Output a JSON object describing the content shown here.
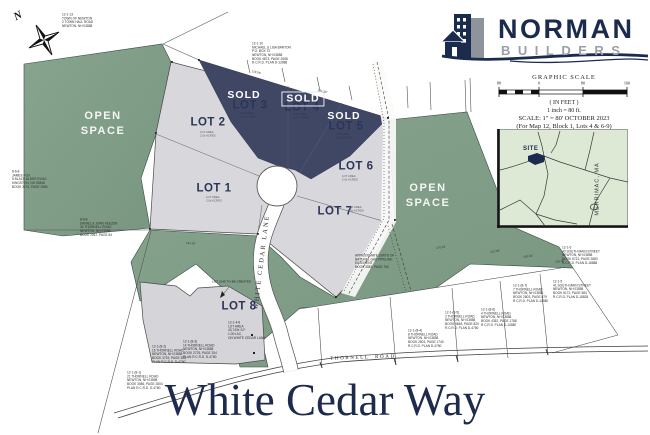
{
  "brand": {
    "primary": "NORMAN",
    "secondary": "BUILDERS",
    "navy": "#1b2b4d",
    "gray": "#9aa0a8"
  },
  "north_label": "N",
  "title": "White Cedar Way",
  "colors": {
    "open_space_green": "#85a08b",
    "lot_gray": "#d8d8dc",
    "sold_navy": "#3f4765",
    "title_navy": "#1e2b4e"
  },
  "scale_block": {
    "heading": "GRAPHIC SCALE",
    "ticks": [
      {
        "t": "80",
        "x": 2
      },
      {
        "t": "0",
        "x": 42
      },
      {
        "t": "80",
        "x": 86
      },
      {
        "t": "160",
        "x": 130
      }
    ],
    "in_feet": "( IN FEET )",
    "inch_note": "1 inch = 80 ft.",
    "scale_line": "SCALE: 1\" = 80'    OCTOBER 2023",
    "subtitle": "(For Map 12, Block 1, Lots 4 & 6-9)"
  },
  "inset_map": {
    "site_label": "SITE",
    "region_label": "MERRIMAC, MA"
  },
  "map": {
    "road_labels": {
      "lane": "WHITE CEDAR LANE",
      "thornell": "THORNELL  ROAD"
    },
    "lot_line_note": "LOT LINE TO BE CREATED",
    "open_space_labels": [
      {
        "x": 103,
        "y": 124,
        "lines": "OPEN\nSPACE"
      },
      {
        "x": 428,
        "y": 196,
        "lines": "OPEN\nSPACE"
      }
    ],
    "lot_labels": [
      {
        "t": "LOT 1",
        "x": 214,
        "y": 189
      },
      {
        "t": "LOT 2",
        "x": 208,
        "y": 123
      },
      {
        "t": "LOT 3",
        "x": 250,
        "y": 106
      },
      {
        "t": "LOT 4",
        "x": 302,
        "y": 108
      },
      {
        "t": "LOT 5",
        "x": 346,
        "y": 127
      },
      {
        "t": "LOT 6",
        "x": 356,
        "y": 167
      },
      {
        "t": "LOT 7",
        "x": 335,
        "y": 212
      },
      {
        "t": "LOT 8",
        "x": 239,
        "y": 307
      }
    ],
    "sold_labels": [
      {
        "t": "SOLD",
        "x": 244,
        "y": 95
      },
      {
        "t": "SOLD",
        "x": 303,
        "y": 99,
        "boxed": true
      },
      {
        "t": "SOLD",
        "x": 344,
        "y": 116
      }
    ],
    "lot_area_notes": [
      {
        "x": 200,
        "y": 131,
        "lines": "LOT AREA\n2.0± ACRES"
      },
      {
        "x": 206,
        "y": 196,
        "lines": "LOT AREA\n2.0± ACRES"
      },
      {
        "x": 240,
        "y": 112,
        "lines": "LOT AREA\n2.0± ACRES",
        "dark": true
      },
      {
        "x": 293,
        "y": 113,
        "lines": "LOT AREA\n2.0± ACRES",
        "dark": true
      },
      {
        "x": 336,
        "y": 133,
        "lines": "LOT AREA\n2.0± ACRES",
        "dark": true
      },
      {
        "x": 342,
        "y": 175,
        "lines": "LOT AREA\n2.0± ACRES"
      },
      {
        "x": 348,
        "y": 206,
        "lines": "LOT AREA\n2.0± ACRES"
      }
    ],
    "parcel_notes": [
      {
        "x": 62,
        "y": 13,
        "lines": "12-1-13\nTOWN OF NEWTON\n2 TOWN HALL ROAD\nNEWTON, NH 03858"
      },
      {
        "x": 252,
        "y": 42,
        "lines": "12-1-10\nMICHAEL & LISA BARTON\nP.O. BOX 73\nNEWTON, NH 03858\nBOOK 4873, PAGE 2658\nR.C.R.D. PLAN D-13988"
      },
      {
        "x": 12,
        "y": 170,
        "lines": "8-6-8\nJAMES FOX\n5 BLACK ALDER ROAD\nKINGSTON, NH 03848\nBOOK 3731, PAGE 2980"
      },
      {
        "x": 80,
        "y": 218,
        "lines": "8-6-8\nDANIEL & JOAN KEEZER\n34 THORNELL ROAD\nNEWTON, NH 03858\nBOOK 2067, PAGE 84"
      },
      {
        "x": 127,
        "y": 371,
        "lines": "12-1-(8-1)\n21 THORNELL ROAD\nNEWTON, NH 03858\nBOOK 3086, PAGE 2804\nPLAN R.C.R.D. D-4780"
      },
      {
        "x": 152,
        "y": 345,
        "lines": "12-1-(8-2)\n16 THORNELL ROAD\nNEWTON, NH 03858\nBOOK 3725, PAGE 358\nPLAN R.C.R.D. D-4780"
      },
      {
        "x": 228,
        "y": 321,
        "lines": "12-1-4-8\nLOT AREA\n43,743± S.F.\n1.00± AC.\nON WHITE CEDAR LANE"
      },
      {
        "x": 183,
        "y": 340,
        "lines": "12-1-(8-3)\n14 THORNELL ROAD\nNEWTON, NH 03858\nBOOK 2725, PAGE 254\nPLAN R.C.R.D. D-4780"
      },
      {
        "x": 408,
        "y": 329,
        "lines": "12-1-(8-4)\n8 THORNELL ROAD\nNEWTON, NH 03858\nBOOK 2803, PAGE 1740\nR.C.R.D. PLAN D-4780"
      },
      {
        "x": 445,
        "y": 311,
        "lines": "12-1-(8-5)\n2 THORNELL ROAD\nNEWTON, NH 03858\nBOOK 5848, PAGE 820\nR.C.R.D. PLAN D-4780"
      },
      {
        "x": 481,
        "y": 308,
        "lines": "12-1-(8-6)\n4 THORNELL ROAD\nNEWTON, NH 03858\nBOOK 4352, PAGE 1788\nR.C.R.D. PLAN D-14580"
      },
      {
        "x": 513,
        "y": 284,
        "lines": "12-1-(8-7)\n7 THORNELL ROAD\nNEWTON, NH 03858\nBOOK 2803, PAGE 679\nR.C.R.D. PLAN D-14580"
      },
      {
        "x": 562,
        "y": 246,
        "lines": "12-1-6\n40 SOUTH MAIN STREET\nNEWTON, NH 03858\nBOOK 6722, PAGE 2883\nR.C.R.D. PLAN D-18888"
      },
      {
        "x": 553,
        "y": 280,
        "lines": "12-1-5\n41 SOUTH MAIN STREET\nNEWTON, NH 03858\nBOOK 5172, PAGE 584\nR.C.R.D. PLAN D-18828"
      },
      {
        "x": 355,
        "y": 254,
        "lines": "APPROXIMATE LIMITS OF\nNATURAL GAS PIPELINE\nEASEMENT\nBOOK 3083, PAGE 760"
      }
    ],
    "dimension_labels": [
      {
        "t": "118.06'",
        "x": 252,
        "y": 70,
        "rot": 14
      },
      {
        "t": "121.30'",
        "x": 318,
        "y": 89,
        "rot": 14
      },
      {
        "t": "249.00'",
        "x": 186,
        "y": 242,
        "rot": 2
      },
      {
        "t": "170.92'",
        "x": 436,
        "y": 247,
        "rot": -8
      },
      {
        "t": "132.09'",
        "x": 490,
        "y": 251,
        "rot": -8
      },
      {
        "t": "180.00'",
        "x": 523,
        "y": 256,
        "rot": -8
      },
      {
        "t": "150.00'",
        "x": 555,
        "y": 261,
        "rot": -8
      }
    ]
  }
}
